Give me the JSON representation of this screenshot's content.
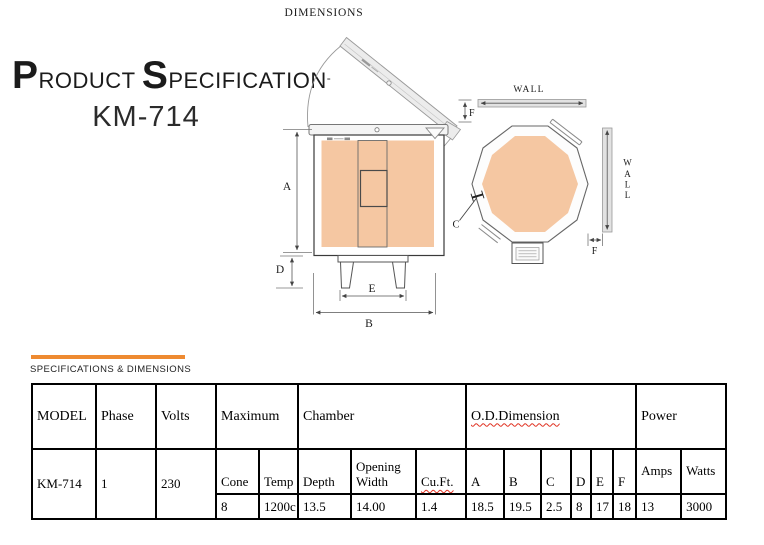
{
  "page": {
    "dimensions_label": "DIMENSIONS"
  },
  "title": {
    "part1_initial": "P",
    "part1_rest": "RODUCT ",
    "part2_initial": "S",
    "part2_rest": "PECIFICATION",
    "trailing_mark": "-",
    "model": "KM-714"
  },
  "section": {
    "label": "SPECIFICATIONS & DIMENSIONS",
    "accent_color": "#EE8A31"
  },
  "drawing": {
    "labels": {
      "dim_a": "A",
      "dim_b": "B",
      "dim_c": "C",
      "dim_d": "D",
      "dim_e": "E",
      "dim_f_top": "F",
      "dim_f_right": "F",
      "wall_top": "WALL",
      "wall_vertical": [
        "W",
        "A",
        "L",
        "L"
      ]
    },
    "colors": {
      "kiln_fill": "#F5C7A2",
      "metal_fill": "#ECECEC",
      "line": "#666666"
    }
  },
  "spec_table": {
    "headers": {
      "model": "MODEL",
      "phase": "Phase",
      "volts": "Volts",
      "maximum": "Maximum",
      "chamber": "Chamber",
      "od_dimension": "O.D.Dimension",
      "power": "Power"
    },
    "subheaders": {
      "cone": "Cone",
      "temp": "Temp",
      "depth": "Depth",
      "opening_width": "Opening Width",
      "cuft": "Cu.Ft.",
      "a": "A",
      "b": "B",
      "c": "C",
      "d": "D",
      "e": "E",
      "f": "F",
      "amps": "Amps",
      "watts": "Watts"
    },
    "row": {
      "model": "KM-714",
      "phase": "1",
      "volts": "230",
      "cone": "8",
      "temp": "1200c",
      "depth": "13.5",
      "opening_width": "14.00",
      "cuft": "1.4",
      "a": "18.5",
      "b": "19.5",
      "c": "2.5",
      "d": "8",
      "e": "17",
      "f": "18",
      "amps": "13",
      "watts": "3000"
    }
  }
}
